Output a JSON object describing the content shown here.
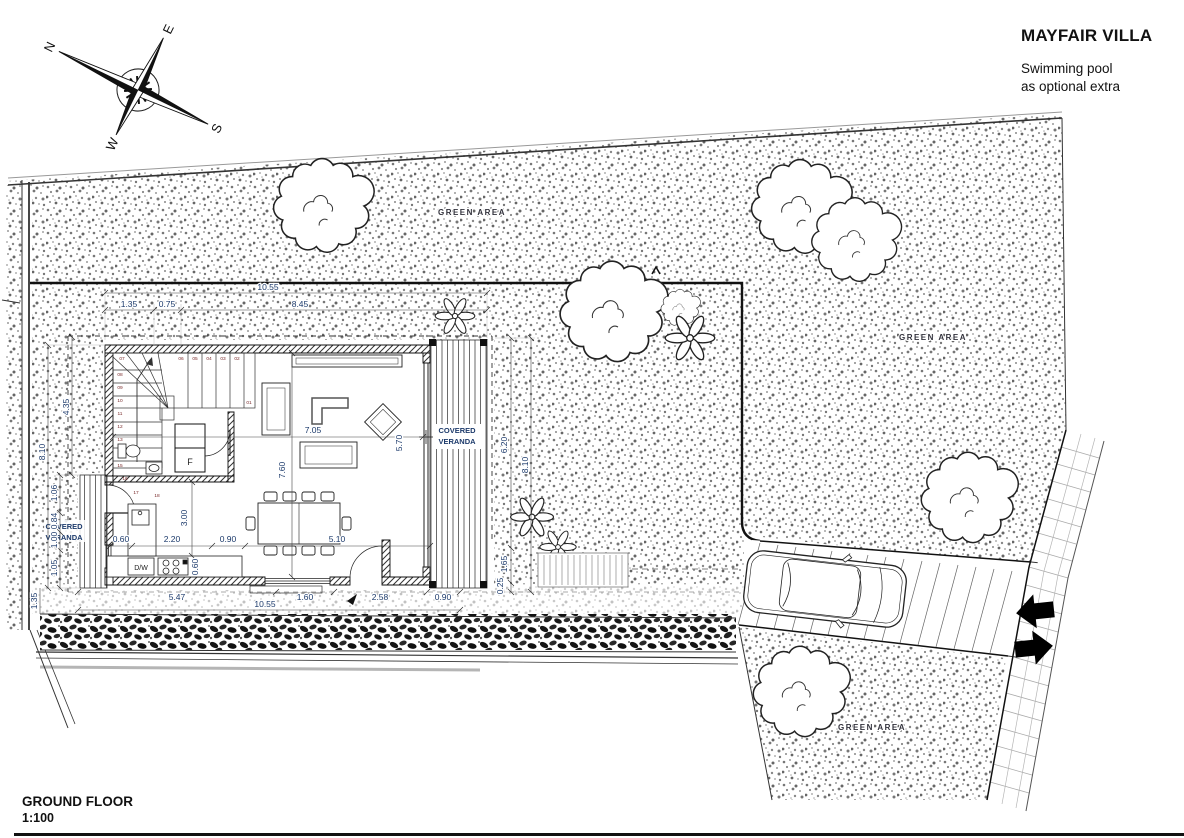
{
  "header": {
    "title": "MAYFAIR VILLA",
    "subtitle_line1": "Swimming pool",
    "subtitle_line2": "as optional extra"
  },
  "footer": {
    "plan_name": "GROUND FLOOR",
    "scale": "1:100"
  },
  "compass": {
    "north": "N",
    "east": "E",
    "south": "S",
    "west": "W"
  },
  "site": {
    "green_area_label": "GREEN AREA",
    "green_areas": [
      "GREEN AREA",
      "GREEN AREA",
      "GREEN AREA"
    ]
  },
  "plan": {
    "veranda_right": {
      "line1": "COVERED",
      "line2": "VERANDA"
    },
    "veranda_left": {
      "line1": "COVERED",
      "line2": "VERANDA"
    },
    "appliances": {
      "dishwasher": "D/W",
      "fridge": "F"
    },
    "stairs": {
      "steps": [
        "01",
        "02",
        "03",
        "04",
        "05",
        "06",
        "07",
        "08",
        "09",
        "10",
        "11",
        "12",
        "13",
        "14",
        "15",
        "16",
        "17",
        "18"
      ]
    },
    "dims": {
      "top": [
        "10.55",
        "1.35",
        "0.75",
        "8.45"
      ],
      "bottom": [
        "5.47",
        "1.60",
        "2.58",
        "0.90",
        "10.55",
        "1.35"
      ],
      "left": [
        "8.10",
        "4.35",
        "1.06",
        "0.84",
        "1.00",
        "1.05"
      ],
      "right": [
        "6.20",
        "8.10",
        "1.65",
        "0.25",
        "5.70"
      ],
      "interior": [
        "7.05",
        "7.60",
        "3.00",
        "5.10",
        "2.20",
        "0.90",
        "0.60",
        "0.60"
      ]
    }
  }
}
